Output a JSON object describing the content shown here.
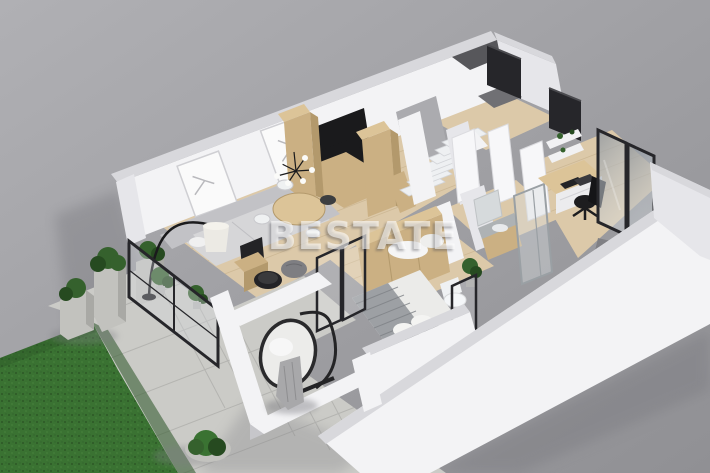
{
  "watermark": {
    "text": "BESTATE"
  },
  "scene": {
    "type": "3d-floor-plan-render",
    "view": "isometric-top-down",
    "rooms": [
      {
        "name": "living-room",
        "objects": [
          "sofa",
          "arc-floor-lamp",
          "wall-art-frames",
          "round-dining-table",
          "dining-chairs",
          "pendant-lamp",
          "coffee-table",
          "pouf",
          "media-cabinet",
          "indoor-plants",
          "glass-sliding-door"
        ]
      },
      {
        "name": "kitchen",
        "objects": [
          "tall-cabinets",
          "base-cabinets",
          "black-countertop"
        ]
      },
      {
        "name": "staircase",
        "objects": [
          "white-stairs",
          "wood-stringer"
        ]
      },
      {
        "name": "hallway",
        "objects": [
          "dark-doors",
          "white-doors",
          "doormat"
        ]
      },
      {
        "name": "office",
        "objects": [
          "desk",
          "desk-chair",
          "wall-shelves",
          "glass-partition"
        ]
      },
      {
        "name": "bathroom",
        "objects": [
          "vanity",
          "mirror",
          "shower-enclosure",
          "toilet",
          "plant"
        ]
      },
      {
        "name": "bedroom",
        "objects": [
          "double-bed",
          "striped-blanket",
          "pillows",
          "wardrobe",
          "framed-windows"
        ]
      },
      {
        "name": "terrace",
        "objects": [
          "hanging-egg-chair",
          "throw-blanket",
          "parapet-walls"
        ]
      },
      {
        "name": "yard",
        "objects": [
          "grass-lawn",
          "paved-patio",
          "concrete-planters",
          "bushes",
          "round-shrub"
        ]
      }
    ]
  },
  "colors": {
    "bg_top": "#b0b0b4",
    "bg_bottom": "#909094",
    "shadow": "#7e7e83",
    "wall_white": "#f3f3f5",
    "wall_cap": "#d8d8dc",
    "wall_shade": "#e6e6ea",
    "wall_dark": "#c6c6ca",
    "floor_wood": "#dcc9a9",
    "floor_line": "#c2ab85",
    "wood": "#cbb083",
    "wood_dark": "#b3996c",
    "wood_light": "#dcc498",
    "counter_black": "#1a1a1c",
    "dark_obj": "#232326",
    "frame_dark": "#26262a",
    "glass": "#d6dbdf",
    "glass_dark": "#8f969e",
    "grass": "#3a7232",
    "grass_dark": "#2a5424",
    "grass_light": "#4c8a3f",
    "patio": "#cbcbc7",
    "patio_line": "#b2b2ae",
    "stone": "#c2c2be",
    "stone_dark": "#a9a9a5",
    "plant": "#35612d",
    "plant_dark": "#264a20",
    "sofa": "#d6d6d8",
    "sofa_dark": "#c2c2c6",
    "fabric": "#9da0a4",
    "fabric_dark": "#7e8186",
    "white_soft": "#f0f0ee",
    "steel": "#9aa0a4",
    "watermark": "rgba(255,255,255,0.58)",
    "watermark_shadow": "rgba(70,70,78,0.38)"
  }
}
